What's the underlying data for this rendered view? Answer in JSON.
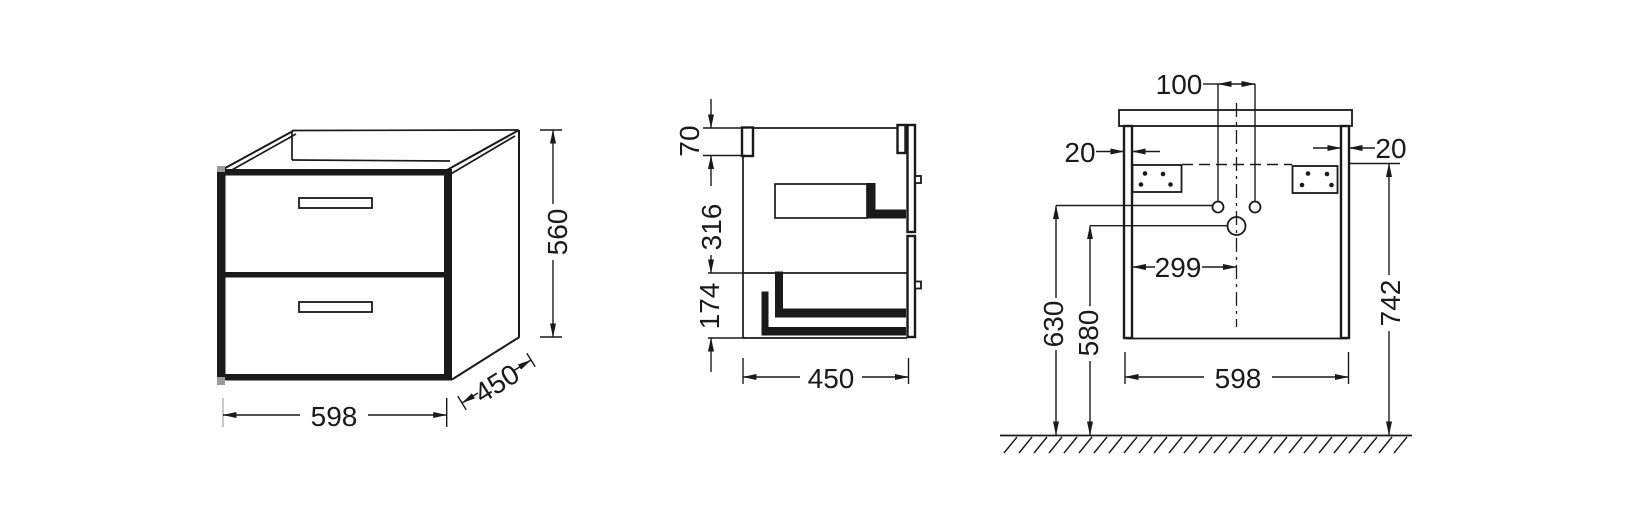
{
  "drawing": {
    "kind": "vanity-cabinet-dimension-drawing",
    "views": {
      "perspective": {
        "dims": {
          "width": "598",
          "depth": "450",
          "height": "560"
        }
      },
      "side_section": {
        "dims": {
          "rail_height": "70",
          "basin_zone": "316",
          "lower_zone": "174",
          "depth": "450"
        }
      },
      "front_elevation": {
        "dims": {
          "hole_spacing": "100",
          "side_thickness_left": "20",
          "side_thickness_right": "20",
          "center_offset": "299",
          "siphon_height": "630",
          "outlet_height": "580",
          "fixing_height": "742",
          "width": "598"
        }
      }
    },
    "colors": {
      "ink": "#1a1a1a",
      "background": "#ffffff",
      "artifact": "#9a9a9a"
    }
  }
}
